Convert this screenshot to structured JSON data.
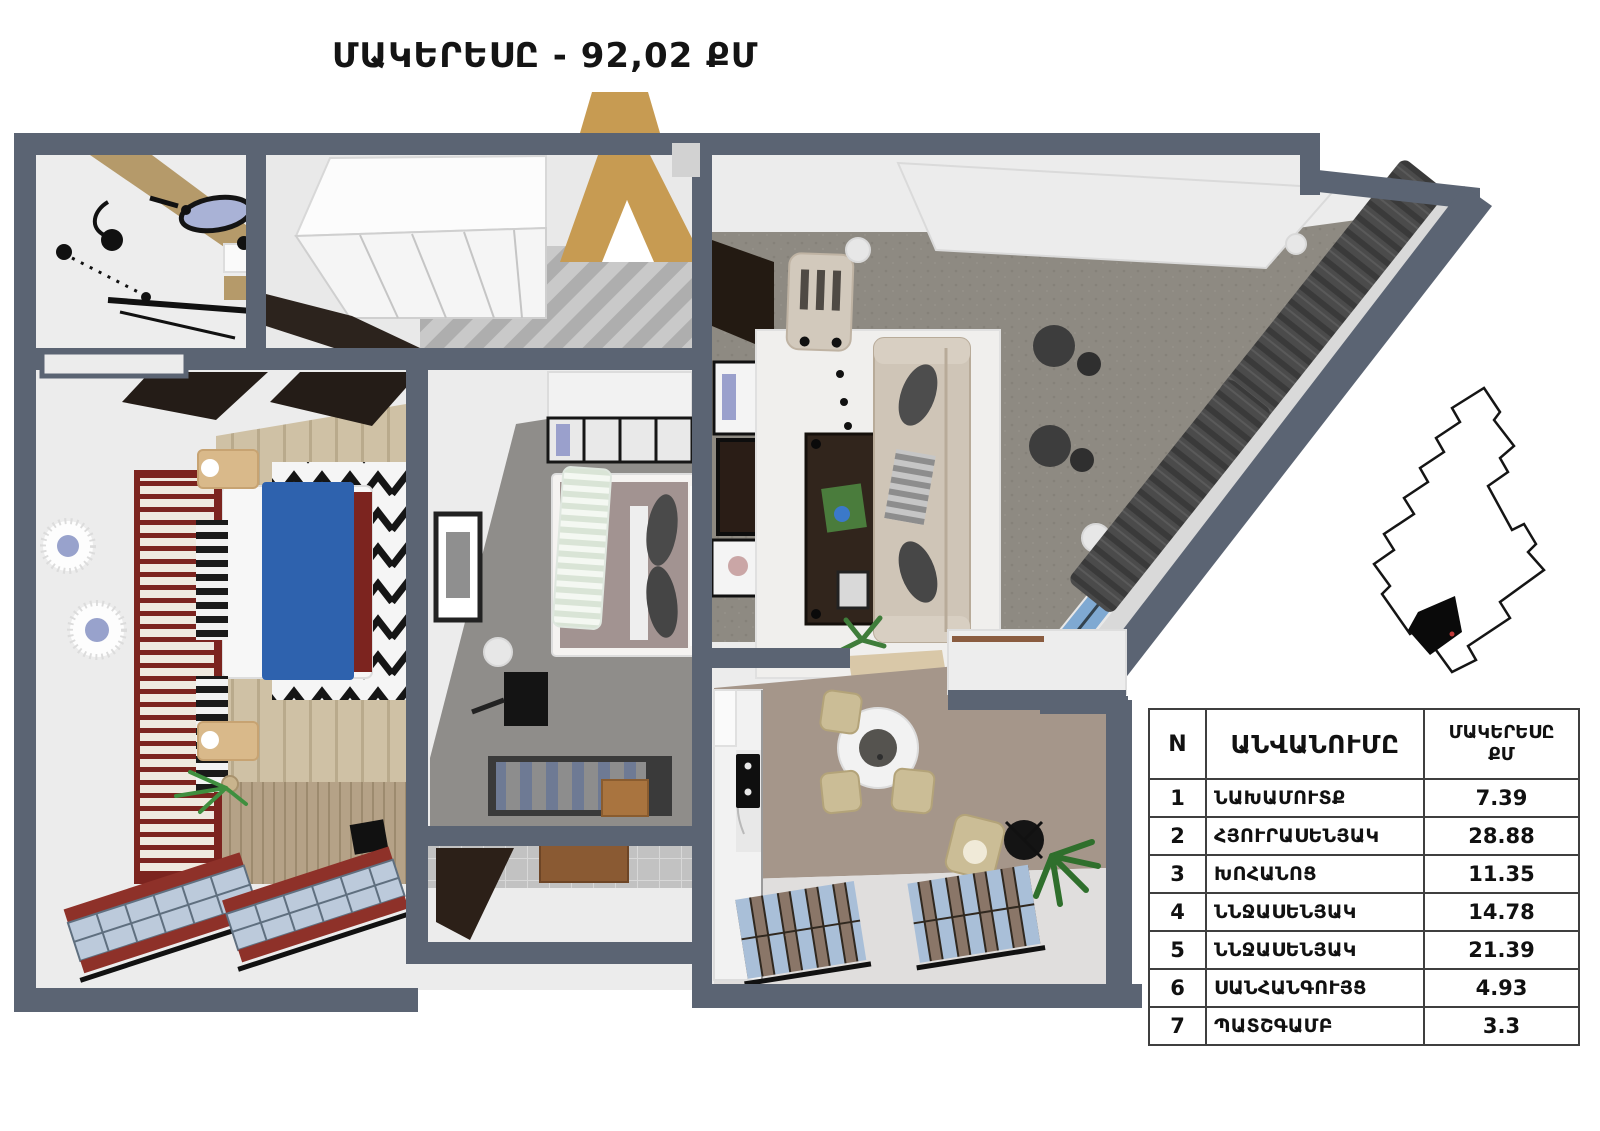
{
  "title": "ՄԱԿԵՐԵՍԸ - 92,02 ՔՄ",
  "table": {
    "headers": {
      "n": "N",
      "name": "ԱՆՎԱՆՈՒՄԸ",
      "area_line1": "ՄԱԿԵՐԵՍԸ",
      "area_line2": "ՔՄ"
    },
    "rows": [
      {
        "n": "1",
        "name": "ՆԱԽԱՄՈՒՏՔ",
        "area": "7.39"
      },
      {
        "n": "2",
        "name": "ՀՅՈՒՐԱՍԵՆՅԱԿ",
        "area": "28.88"
      },
      {
        "n": "3",
        "name": "ԽՈՀԱՆՈՑ",
        "area": "11.35"
      },
      {
        "n": "4",
        "name": "ՆՆՋԱՍԵՆՅԱԿ",
        "area": "14.78"
      },
      {
        "n": "5",
        "name": "ՆՆՋԱՍԵՆՅԱԿ",
        "area": "21.39"
      },
      {
        "n": "6",
        "name": "ՍԱՆՀԱՆԳՈՒՅՑ",
        "area": "4.93"
      },
      {
        "n": "7",
        "name": "ՊԱՏՇԳԱՄԲ",
        "area": "3.3"
      }
    ]
  },
  "palette": {
    "wall": "#5b6473",
    "carpet": "#8e8a82",
    "glass": "#7fa9d2",
    "wood": "#cfc1a5",
    "accentRed": "#7c241f",
    "benchRed": "#8e3129",
    "blanketBlue": "#2e62ae",
    "sofaBeige": "#cfc5b7",
    "kitchenFloor": "#a5968a",
    "doorTan": "#c79b52",
    "curtain": "#4b4b4b"
  }
}
